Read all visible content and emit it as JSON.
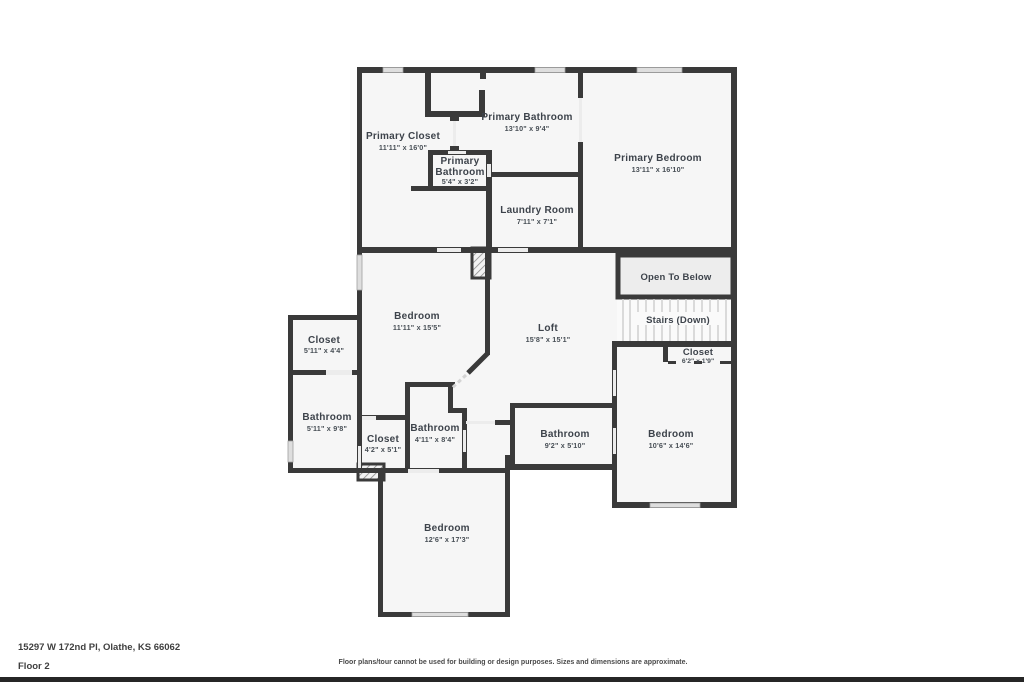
{
  "address": {
    "line": "15297 W 172nd Pl, Olathe, KS 66062",
    "floor": "Floor 2"
  },
  "disclaimer": "Floor plans/tour cannot be used for building or design purposes. Sizes and dimensions are approximate.",
  "colors": {
    "wall": "#3a3a3a",
    "room_fill": "#f6f6f6",
    "label_text": "#3d434b",
    "window_fill": "#dedede",
    "door_fill": "#ececec",
    "open_to_below_fill": "#ededed",
    "stair_tread": "#cfcfcf",
    "footer_bar": "#262626"
  },
  "rooms": [
    {
      "id": "primary-closet",
      "name": "Primary Closet",
      "dims": "11'11\" x 16'0\""
    },
    {
      "id": "primary-bathroom",
      "name": "Primary Bathroom",
      "dims": "13'10\" x 9'4\""
    },
    {
      "id": "primary-bathroom-small",
      "line1": "Primary",
      "line2": "Bathroom",
      "dims": "5'4\" x 3'2\""
    },
    {
      "id": "laundry-room",
      "name": "Laundry Room",
      "dims": "7'11\" x 7'1\""
    },
    {
      "id": "primary-bedroom",
      "name": "Primary Bedroom",
      "dims": "13'11\" x 16'10\""
    },
    {
      "id": "open-to-below",
      "name": "Open To Below"
    },
    {
      "id": "stairs",
      "name": "Stairs (Down)"
    },
    {
      "id": "closet-hall",
      "name": "Closet",
      "dims": "6'2\" x 1'9\""
    },
    {
      "id": "bedroom-upper",
      "name": "Bedroom",
      "dims": "11'11\" x 15'5\""
    },
    {
      "id": "loft",
      "name": "Loft",
      "dims": "15'8\" x 15'1\""
    },
    {
      "id": "closet-left",
      "name": "Closet",
      "dims": "5'11\" x 4'4\""
    },
    {
      "id": "bathroom-left",
      "name": "Bathroom",
      "dims": "5'11\" x 9'8\""
    },
    {
      "id": "closet-mid",
      "name": "Closet",
      "dims": "4'2\" x 5'1\""
    },
    {
      "id": "bathroom-mid",
      "name": "Bathroom",
      "dims": "4'11\" x 8'4\""
    },
    {
      "id": "bathroom-right",
      "name": "Bathroom",
      "dims": "9'2\" x 5'10\""
    },
    {
      "id": "bedroom-right",
      "name": "Bedroom",
      "dims": "10'6\" x 14'6\""
    },
    {
      "id": "bedroom-bottom",
      "name": "Bedroom",
      "dims": "12'6\" x 17'3\""
    }
  ]
}
